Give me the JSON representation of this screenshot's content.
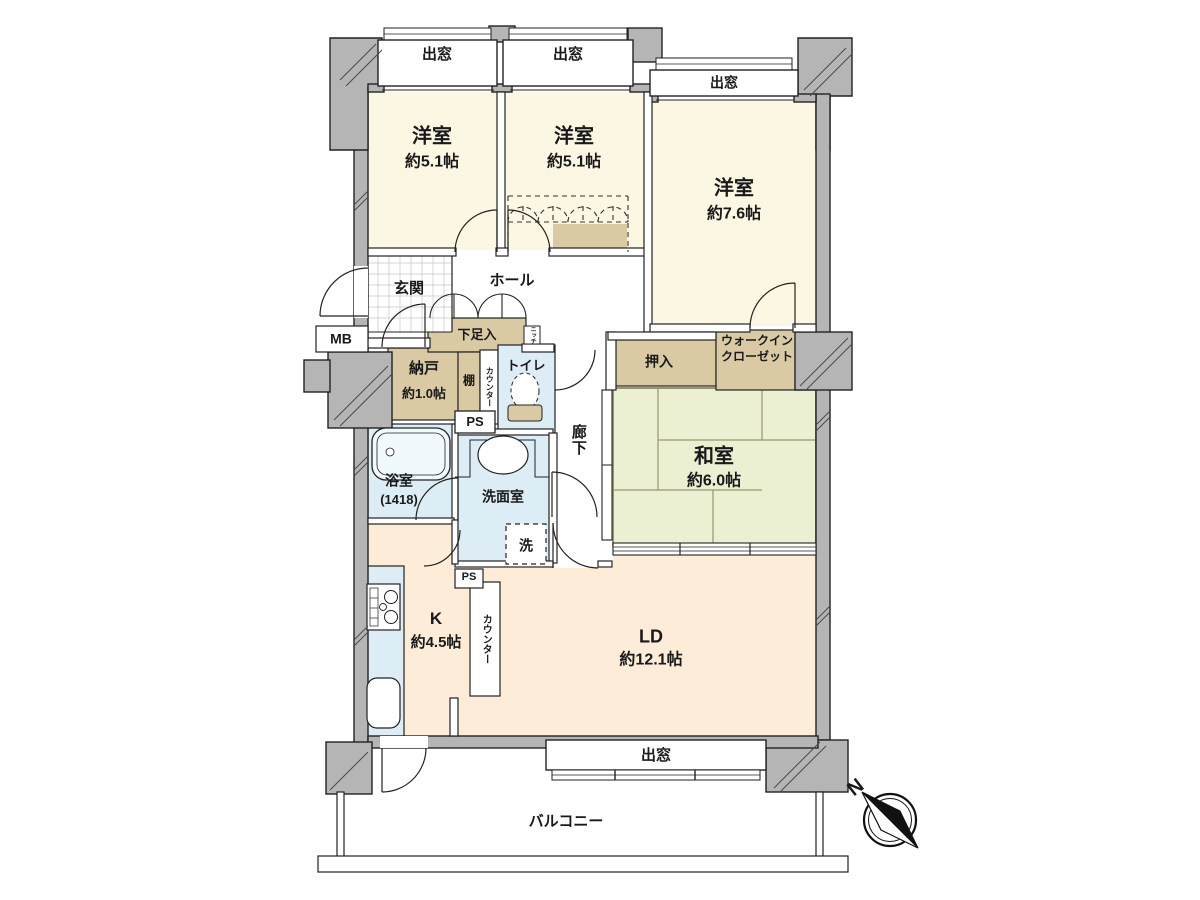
{
  "plan": {
    "rooms": {
      "bedroom1": {
        "name": "洋室",
        "size": "約5.1帖"
      },
      "bedroom2": {
        "name": "洋室",
        "size": "約5.1帖"
      },
      "bedroom3": {
        "name": "洋室",
        "size": "約7.6帖"
      },
      "japanese_room": {
        "name": "和室",
        "size": "約6.0帖"
      },
      "living_dining": {
        "name": "LD",
        "size": "約12.1帖"
      },
      "kitchen": {
        "name": "K",
        "size": "約4.5帖"
      },
      "storage_room": {
        "name": "納戸",
        "size": "約1.0帖"
      }
    },
    "labels": {
      "entrance": "玄関",
      "hall": "ホール",
      "shoe_cabinet": "下足入",
      "meter_box": "MB",
      "shelf": "棚",
      "counter": "カウンター",
      "toilet": "トイレ",
      "niche": "ニッチ",
      "pipe_space": "PS",
      "corridor": "廊下",
      "closet_oshiire": "押入",
      "walk_in_closet_line1": "ウォークイン",
      "walk_in_closet_line2": "クローゼット",
      "bathroom": "浴室",
      "bathroom_size": "(1418)",
      "washroom": "洗面室",
      "washing_machine": "洗",
      "bay_window": "出窓",
      "balcony": "バルコニー",
      "compass_north": "N"
    },
    "colors": {
      "western_room": "#fbf7e2",
      "living_dining_kitchen": "#fcecd8",
      "tatami": "#eaf0d1",
      "storage": "#d9caa4",
      "wet_area": "#dcedf6",
      "wall_gray": "#b5b5b5",
      "tatami_line": "#96966e"
    }
  }
}
